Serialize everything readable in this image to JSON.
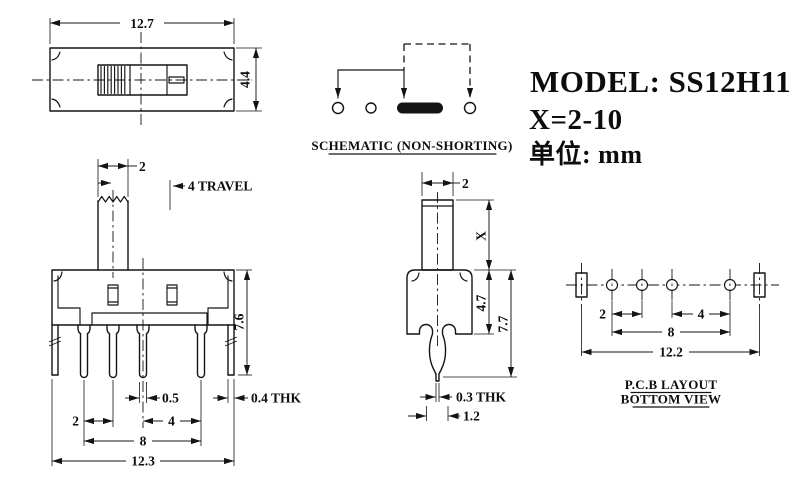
{
  "drawing": {
    "background_color": "#ffffff",
    "line_color": "#141414",
    "title_block": {
      "model": "MODEL: SS12H11",
      "x_range": "X=2-10",
      "unit": "单位: mm"
    },
    "top_view": {
      "dim_width": "12.7",
      "dim_height": "4.4"
    },
    "schematic": {
      "caption": "SCHEMATIC (NON-SHORTING)"
    },
    "front_view": {
      "dim_knob_width": "2",
      "travel_note": "4 TRAVEL",
      "dim_body_height": "7.6",
      "dim_pin_width": "0.5",
      "dim_leg_thickness": "0.4 THK",
      "dim_pitch_left": "2",
      "dim_pitch_right": "4",
      "dim_pin_span": "8",
      "dim_overall_width": "12.3"
    },
    "side_view": {
      "dim_knob_width": "2",
      "dim_knob_height": "X",
      "dim_body_height": "4.7",
      "dim_overall_height": "7.7",
      "dim_pin_thickness": "0.3 THK",
      "dim_pin_width": "1.2"
    },
    "pcb_layout": {
      "caption_line1": "P.C.B LAYOUT",
      "caption_line2": "BOTTOM VIEW",
      "dim_pitch_left": "2",
      "dim_pitch_right": "4",
      "dim_pin_span": "8",
      "dim_overall_width": "12.2"
    }
  }
}
